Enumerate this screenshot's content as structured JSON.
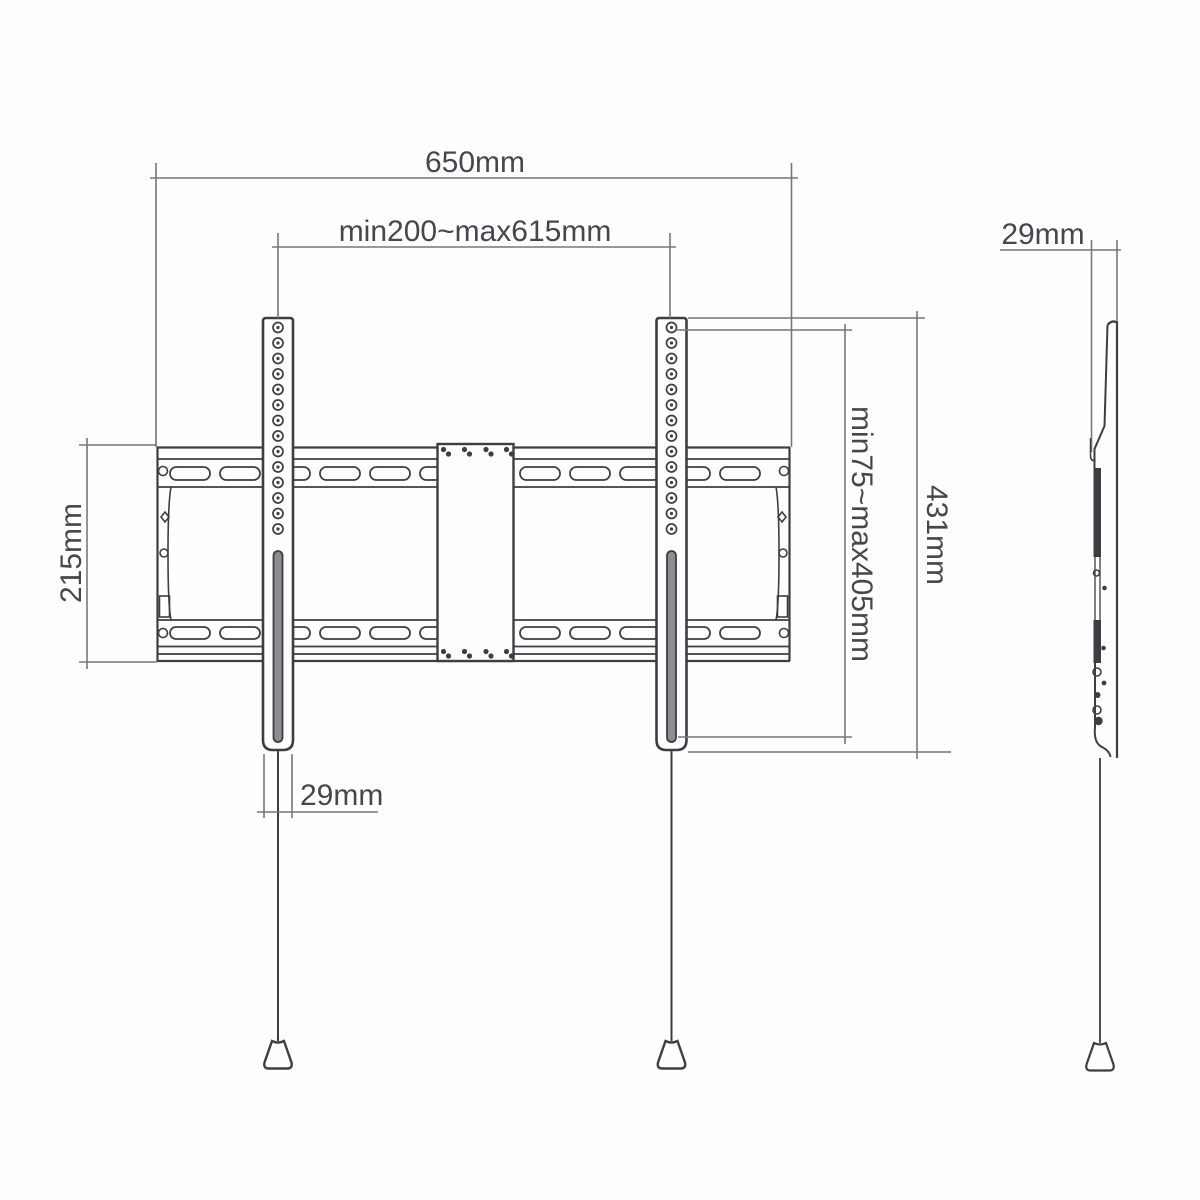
{
  "colors": {
    "outline": "#3d3d44",
    "dimension": "#77777b",
    "slot_fill": "#8d8d91",
    "text": "#46464c",
    "background": "#fefefe"
  },
  "front_view": {
    "width_total": "650mm",
    "width_range": "min200~max615mm",
    "plate_height": "215mm",
    "rail_span_range": "min75~max405mm",
    "rail_height_total": "431mm",
    "rail_width": "29mm"
  },
  "side_view": {
    "depth": "29mm"
  }
}
